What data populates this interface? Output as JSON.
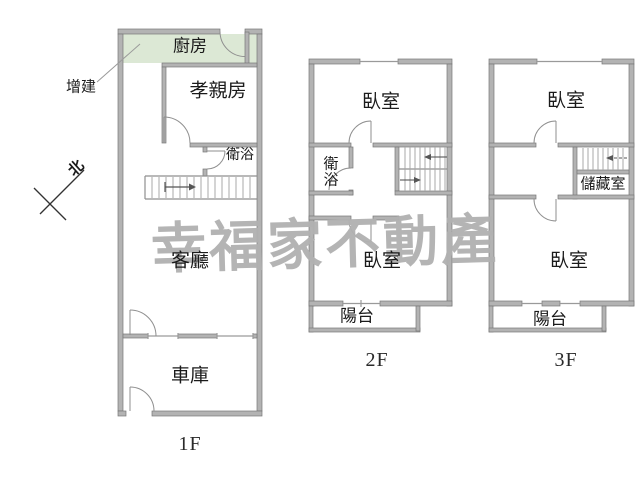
{
  "watermark": {
    "text": "幸福家不動產",
    "color": "#b1b1b1"
  },
  "compass": {
    "north_label": "北"
  },
  "annotations": {
    "addition": "增建"
  },
  "colors": {
    "kitchen_fill": "#dce8d5",
    "wall": "#b3b3b3",
    "wall_edge": "#787878",
    "line": "#8f8f8f"
  },
  "floors": [
    {
      "label": "1F",
      "rooms": {
        "kitchen": "廚房",
        "parents_room": "孝親房",
        "bathroom": "衛浴",
        "living_room": "客廳",
        "garage": "車庫"
      }
    },
    {
      "label": "2F",
      "rooms": {
        "bedroom_top": "臥室",
        "bathroom": "衛浴",
        "bedroom_bottom": "臥室",
        "balcony": "陽台"
      }
    },
    {
      "label": "3F",
      "rooms": {
        "bedroom_top": "臥室",
        "storage": "儲藏室",
        "bedroom_bottom": "臥室",
        "balcony": "陽台"
      }
    }
  ]
}
